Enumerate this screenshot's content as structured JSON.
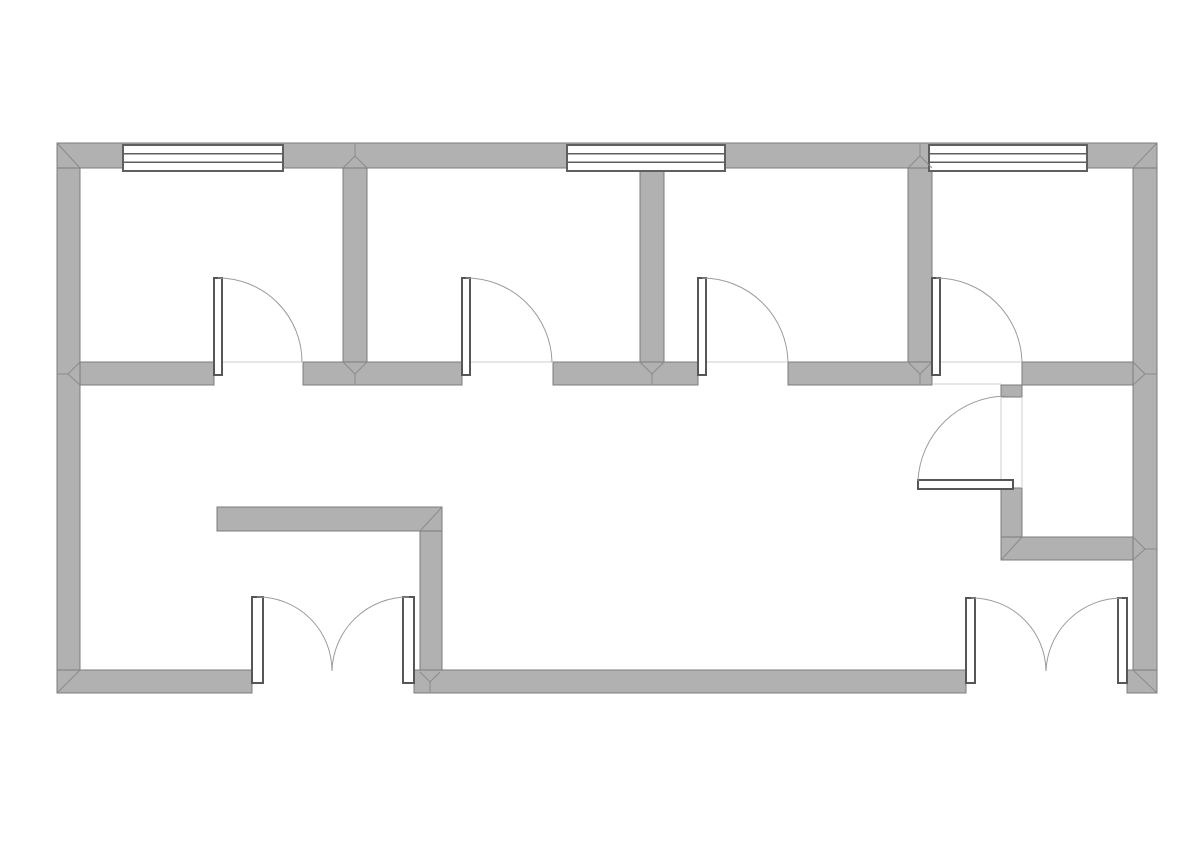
{
  "compass": {
    "north_label": "N",
    "south_label": "S",
    "circle_color": "#a9d5ef",
    "north_needle_color": "#4aa1dc",
    "south_needle_color": "#d9d9d9",
    "south_needle_edge": "#c4c4c4",
    "label_color": "#3c3c3c"
  },
  "floorplan": {
    "canvas": {
      "width": 1191,
      "height": 842,
      "background": "#ffffff"
    },
    "colors": {
      "wall_fill": "#b1b1b1",
      "wall_stroke": "#7c7c7c",
      "miter_line": "#8a8a8a",
      "window_stroke": "#5f5f5f",
      "door_frame_stroke": "#565656",
      "door_arc": "#9c9c9c",
      "threshold_line": "#cfcfcf"
    },
    "walls": [
      {
        "name": "left-exterior-wall",
        "x": 57,
        "y": 143,
        "w": 23,
        "h": 550
      },
      {
        "name": "right-exterior-wall",
        "x": 1133,
        "y": 143,
        "w": 24,
        "h": 550
      },
      {
        "name": "divider-wall-room1-room2",
        "x": 343,
        "y": 168,
        "w": 24,
        "h": 194
      },
      {
        "name": "divider-wall-room2-room3",
        "x": 640,
        "y": 168,
        "w": 24,
        "h": 194
      },
      {
        "name": "divider-wall-room3-room4",
        "x": 908,
        "y": 168,
        "w": 24,
        "h": 194
      },
      {
        "name": "closet-left-wall-stub",
        "x": 1001,
        "y": 385,
        "w": 21,
        "h": 12
      },
      {
        "name": "closet-left-wall",
        "x": 1001,
        "y": 488,
        "w": 21,
        "h": 72
      },
      {
        "name": "vestibule-wall-vertical",
        "x": 420,
        "y": 531,
        "w": 22,
        "h": 141
      },
      {
        "name": "top-exterior-wall",
        "x": 57,
        "y": 143,
        "w": 1100,
        "h": 25
      },
      {
        "name": "corridor-wall-segment-1",
        "x": 80,
        "y": 362,
        "w": 134,
        "h": 23
      },
      {
        "name": "corridor-wall-segment-2",
        "x": 303,
        "y": 362,
        "w": 159,
        "h": 23
      },
      {
        "name": "corridor-wall-segment-3",
        "x": 553,
        "y": 362,
        "w": 145,
        "h": 23
      },
      {
        "name": "corridor-wall-segment-4",
        "x": 788,
        "y": 362,
        "w": 144,
        "h": 23
      },
      {
        "name": "corridor-wall-segment-5",
        "x": 1022,
        "y": 362,
        "w": 111,
        "h": 23
      },
      {
        "name": "closet-bottom-wall",
        "x": 1001,
        "y": 537,
        "w": 132,
        "h": 23
      },
      {
        "name": "vestibule-wall-horizontal",
        "x": 217,
        "y": 507,
        "w": 225,
        "h": 24
      },
      {
        "name": "bottom-exterior-wall-left",
        "x": 57,
        "y": 670,
        "w": 195,
        "h": 23
      },
      {
        "name": "bottom-exterior-wall-middle",
        "x": 414,
        "y": 670,
        "w": 552,
        "h": 23
      },
      {
        "name": "bottom-exterior-wall-right",
        "x": 1127,
        "y": 670,
        "w": 30,
        "h": 23
      }
    ],
    "windows": [
      {
        "name": "window-1",
        "x": 123,
        "y": 145,
        "w": 160,
        "h": 26
      },
      {
        "name": "window-2",
        "x": 567,
        "y": 145,
        "w": 158,
        "h": 26
      },
      {
        "name": "window-3",
        "x": 929,
        "y": 145,
        "w": 158,
        "h": 26
      }
    ],
    "door_leaves": [
      {
        "name": "room1-door-leaf",
        "x": 214,
        "y": 278,
        "w": 8,
        "h": 97
      },
      {
        "name": "room2-door-leaf",
        "x": 462,
        "y": 278,
        "w": 8,
        "h": 97
      },
      {
        "name": "room3-door-leaf",
        "x": 698,
        "y": 278,
        "w": 8,
        "h": 97
      },
      {
        "name": "room4-door-leaf",
        "x": 932,
        "y": 278,
        "w": 8,
        "h": 97
      },
      {
        "name": "closet-door-leaf",
        "x": 918,
        "y": 480,
        "w": 95,
        "h": 9
      },
      {
        "name": "entry-left-door-leaf",
        "x": 252,
        "y": 597,
        "w": 11,
        "h": 86
      },
      {
        "name": "entry-right-door-leaf",
        "x": 403,
        "y": 597,
        "w": 11,
        "h": 86
      },
      {
        "name": "entry2-left-door-leaf",
        "x": 966,
        "y": 598,
        "w": 9,
        "h": 85
      },
      {
        "name": "entry2-right-door-leaf",
        "x": 1118,
        "y": 598,
        "w": 9,
        "h": 85
      }
    ],
    "door_arcs": [
      {
        "name": "room1-door-swing",
        "d": "M 218 278 A 84 84 0 0 1 302 362"
      },
      {
        "name": "room2-door-swing",
        "d": "M 466 278 A 86 86 0 0 1 552 362"
      },
      {
        "name": "room3-door-swing",
        "d": "M 702 278 A 86 86 0 0 1 788 362"
      },
      {
        "name": "room4-door-swing",
        "d": "M 936 278 A 86 86 0 0 1 1022 362"
      },
      {
        "name": "closet-door-swing",
        "d": "M 918 481 A 89 89 0 0 1 1006 396"
      },
      {
        "name": "entry-left-door-swing",
        "d": "M 257 597 A 74 74 0 0 1 332 671"
      },
      {
        "name": "entry-right-door-swing",
        "d": "M 409 597 A 76 76 0 0 0 332 671"
      },
      {
        "name": "entry2-left-door-swing",
        "d": "M 971 598 A 74 74 0 0 1 1046 671"
      },
      {
        "name": "entry2-right-door-swing",
        "d": "M 1122 598 A 76 76 0 0 0 1046 671"
      }
    ],
    "thresholds": [
      {
        "x1": 214,
        "y1": 362,
        "x2": 303,
        "y2": 362
      },
      {
        "x1": 462,
        "y1": 362,
        "x2": 553,
        "y2": 362
      },
      {
        "x1": 698,
        "y1": 362,
        "x2": 788,
        "y2": 362
      },
      {
        "x1": 932,
        "y1": 362,
        "x2": 1022,
        "y2": 362
      },
      {
        "x1": 932,
        "y1": 384,
        "x2": 1001,
        "y2": 384
      },
      {
        "x1": 1001,
        "y1": 397,
        "x2": 1001,
        "y2": 488
      },
      {
        "x1": 1022,
        "y1": 397,
        "x2": 1022,
        "y2": 488
      }
    ],
    "miters": [
      {
        "x1": 57,
        "y1": 143,
        "x2": 80,
        "y2": 168
      },
      {
        "x1": 1157,
        "y1": 143,
        "x2": 1133,
        "y2": 168
      },
      {
        "x1": 57,
        "y1": 693,
        "x2": 80,
        "y2": 670
      },
      {
        "x1": 1157,
        "y1": 693,
        "x2": 1133,
        "y2": 670
      },
      {
        "x1": 442,
        "y1": 507,
        "x2": 420,
        "y2": 531
      },
      {
        "x1": 1001,
        "y1": 560,
        "x2": 1022,
        "y2": 537
      },
      {
        "x1": 343,
        "y1": 168,
        "x2": 355,
        "y2": 156
      },
      {
        "x1": 367,
        "y1": 168,
        "x2": 355,
        "y2": 156
      },
      {
        "x1": 355,
        "y1": 156,
        "x2": 355,
        "y2": 143
      },
      {
        "x1": 908,
        "y1": 168,
        "x2": 920,
        "y2": 156
      },
      {
        "x1": 932,
        "y1": 168,
        "x2": 920,
        "y2": 156
      },
      {
        "x1": 920,
        "y1": 156,
        "x2": 920,
        "y2": 143
      },
      {
        "x1": 343,
        "y1": 362,
        "x2": 355,
        "y2": 374
      },
      {
        "x1": 367,
        "y1": 362,
        "x2": 355,
        "y2": 374
      },
      {
        "x1": 355,
        "y1": 374,
        "x2": 355,
        "y2": 385
      },
      {
        "x1": 640,
        "y1": 362,
        "x2": 652,
        "y2": 374
      },
      {
        "x1": 664,
        "y1": 362,
        "x2": 652,
        "y2": 374
      },
      {
        "x1": 652,
        "y1": 374,
        "x2": 652,
        "y2": 385
      },
      {
        "x1": 908,
        "y1": 362,
        "x2": 920,
        "y2": 374
      },
      {
        "x1": 932,
        "y1": 362,
        "x2": 920,
        "y2": 374
      },
      {
        "x1": 920,
        "y1": 374,
        "x2": 920,
        "y2": 385
      },
      {
        "x1": 80,
        "y1": 362,
        "x2": 68,
        "y2": 374
      },
      {
        "x1": 80,
        "y1": 385,
        "x2": 68,
        "y2": 374
      },
      {
        "x1": 68,
        "y1": 374,
        "x2": 57,
        "y2": 374
      },
      {
        "x1": 1133,
        "y1": 362,
        "x2": 1145,
        "y2": 374
      },
      {
        "x1": 1133,
        "y1": 385,
        "x2": 1145,
        "y2": 374
      },
      {
        "x1": 1145,
        "y1": 374,
        "x2": 1157,
        "y2": 374
      },
      {
        "x1": 1133,
        "y1": 537,
        "x2": 1145,
        "y2": 549
      },
      {
        "x1": 1133,
        "y1": 560,
        "x2": 1145,
        "y2": 549
      },
      {
        "x1": 1145,
        "y1": 549,
        "x2": 1157,
        "y2": 549
      },
      {
        "x1": 420,
        "y1": 672,
        "x2": 430,
        "y2": 682
      },
      {
        "x1": 440,
        "y1": 672,
        "x2": 430,
        "y2": 682
      },
      {
        "x1": 430,
        "y1": 682,
        "x2": 430,
        "y2": 693
      }
    ]
  }
}
